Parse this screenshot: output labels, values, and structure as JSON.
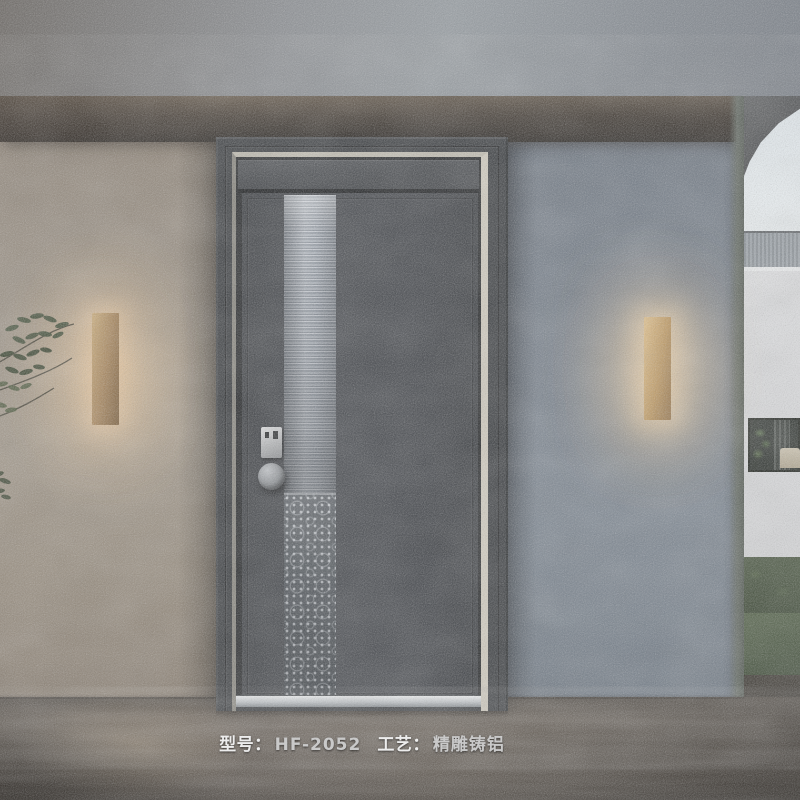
{
  "caption": {
    "model_label": "型号：",
    "model_value": "HF-2052",
    "craft_label": "工艺：",
    "craft_value": "精雕铸铝"
  },
  "colors": {
    "door_leaf": "#45484c",
    "door_frame": "#3a3d40",
    "silver_trim": "#d2cdc0",
    "ribbed_glass": "#9aa1aa",
    "cast_panel": "#4e545a",
    "threshold": "#c3c8cc",
    "sconce_gold": "#c2a06b",
    "sconce_glow": "#ffd9a5",
    "left_wall": "#998e80",
    "right_wall": "#78818c",
    "canopy_shadow": "#3a332d",
    "sky": "#ecf2f5",
    "background_house": "#dcddde",
    "hedge_green": "#46523d",
    "floor": "#655d54",
    "caption_text": "#ededed"
  }
}
